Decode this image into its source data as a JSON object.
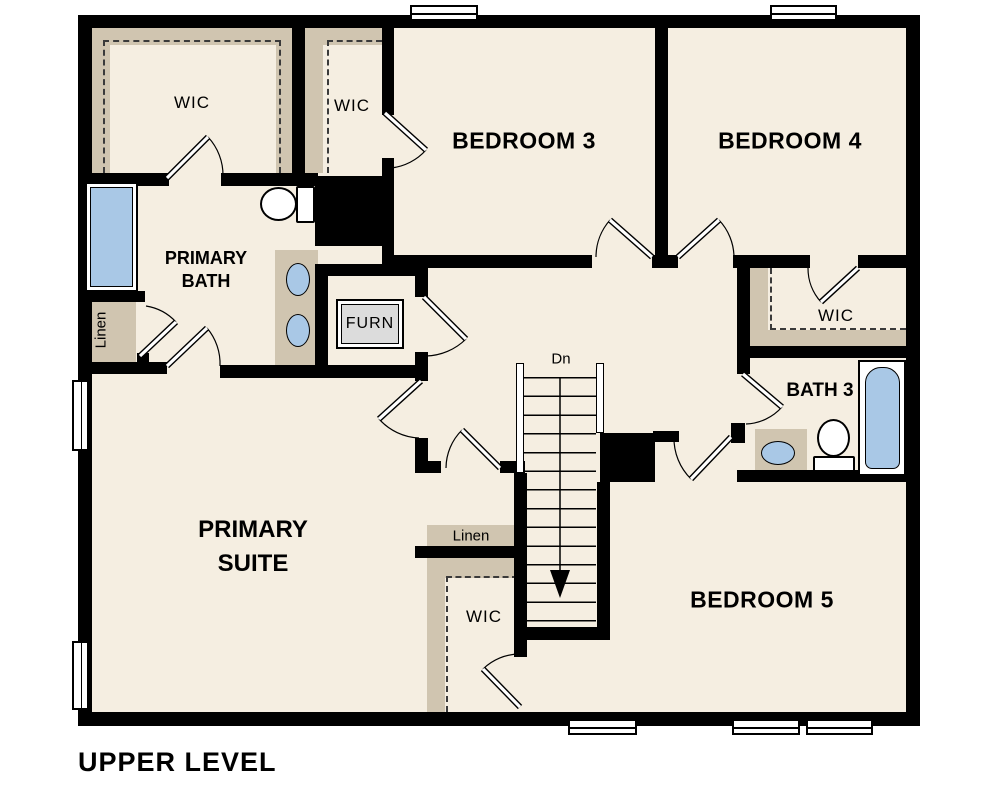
{
  "plan_title": "UPPER LEVEL",
  "colors": {
    "floor": "#f5eee1",
    "wall": "#000000",
    "closet_shelf": "#d0c5b0",
    "fixture_blue": "#a9c8e6",
    "furnace_gray": "#dcdcdc",
    "background": "#ffffff"
  },
  "rooms": {
    "wic_primary": {
      "label": "WIC"
    },
    "wic_bedroom3": {
      "label": "WIC"
    },
    "bedroom3": {
      "label": "BEDROOM 3"
    },
    "bedroom4": {
      "label": "BEDROOM 4"
    },
    "primary_bath": {
      "line1": "PRIMARY",
      "line2": "BATH"
    },
    "primary_suite": {
      "line1": "PRIMARY",
      "line2": "SUITE"
    },
    "wic_bedroom4": {
      "label": "WIC"
    },
    "bath3": {
      "label": "BATH 3"
    },
    "bedroom5": {
      "label": "BEDROOM 5"
    },
    "wic_bedroom5": {
      "label": "WIC"
    },
    "linen_hall": {
      "label": "Linen"
    },
    "linen_primary": {
      "label": "Linen"
    },
    "furnace": {
      "label": "FURN"
    },
    "stairs": {
      "label": "Dn"
    }
  }
}
